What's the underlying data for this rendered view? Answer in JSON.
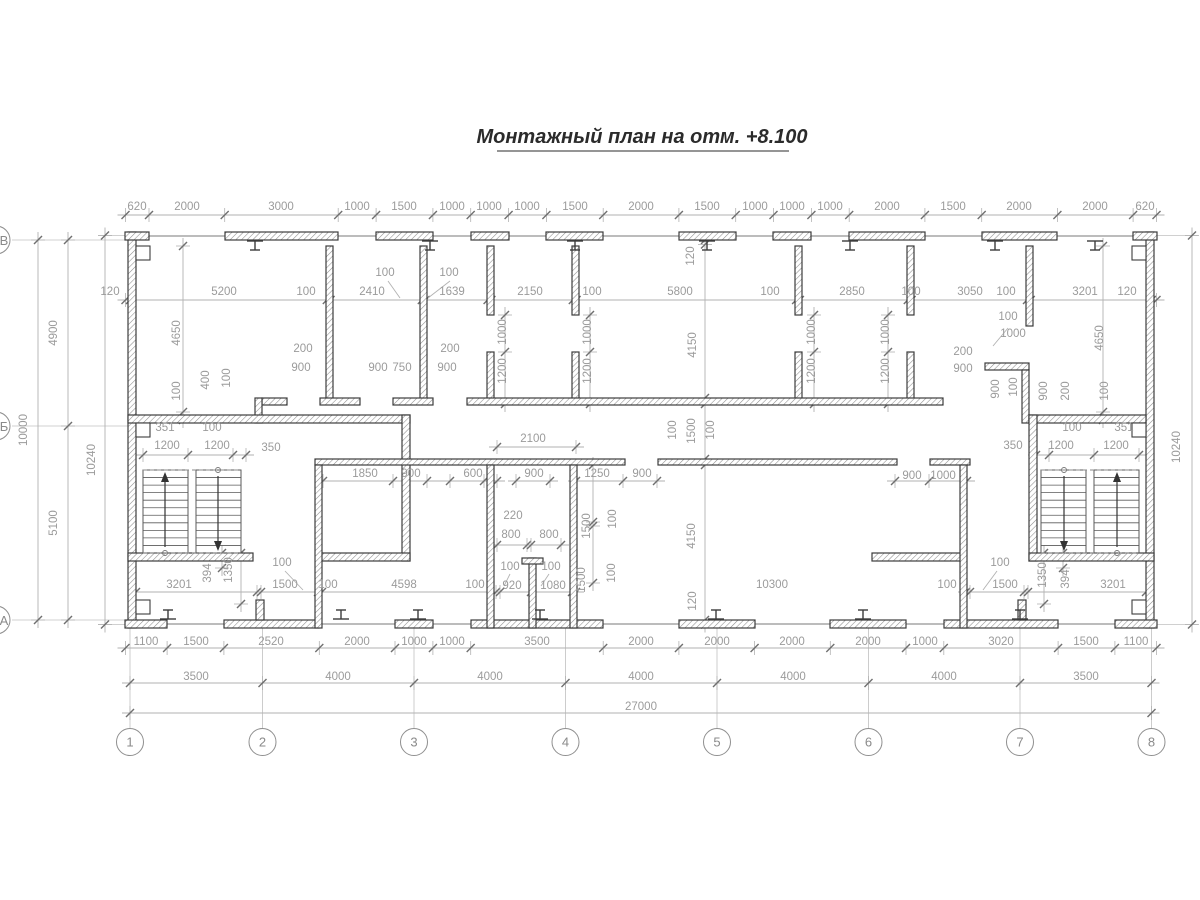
{
  "title": "Монтажный план на отм. +8.100",
  "colors": {
    "wall_line": "#3c3c3c",
    "dim_text": "#9b9b9b",
    "dim_line": "#b2b2b2",
    "tick": "#6f6f6f",
    "axis_line": "#c0c0c0",
    "bubble": "#8f8f8f",
    "stair": "#5a5a5a",
    "title": "#2b2b2b"
  },
  "grid": {
    "columns": [
      {
        "label": "1",
        "x": 130
      },
      {
        "label": "2",
        "x": 262.5
      },
      {
        "label": "3",
        "x": 414
      },
      {
        "label": "4",
        "x": 565.5
      },
      {
        "label": "5",
        "x": 717
      },
      {
        "label": "6",
        "x": 868.5
      },
      {
        "label": "7",
        "x": 1020
      },
      {
        "label": "8",
        "x": 1151.5
      }
    ],
    "bubble_y": 742,
    "rows": [
      {
        "label": "В",
        "y": 240
      },
      {
        "label": "Б",
        "y": 426
      },
      {
        "label": "А",
        "y": 620
      }
    ]
  },
  "dimension_labels": [
    [
      "620",
      137,
      210,
      0
    ],
    [
      "2000",
      187,
      210,
      0
    ],
    [
      "3000",
      281,
      210,
      0
    ],
    [
      "1000",
      357,
      210,
      0
    ],
    [
      "1500",
      404,
      210,
      0
    ],
    [
      "1000",
      452,
      210,
      0
    ],
    [
      "1000",
      489,
      210,
      0
    ],
    [
      "1000",
      527,
      210,
      0
    ],
    [
      "1500",
      575,
      210,
      0
    ],
    [
      "2000",
      641,
      210,
      0
    ],
    [
      "1500",
      707,
      210,
      0
    ],
    [
      "1000",
      755,
      210,
      0
    ],
    [
      "1000",
      792,
      210,
      0
    ],
    [
      "1000",
      830,
      210,
      0
    ],
    [
      "2000",
      887,
      210,
      0
    ],
    [
      "1500",
      953,
      210,
      0
    ],
    [
      "2000",
      1019,
      210,
      0
    ],
    [
      "2000",
      1095,
      210,
      0
    ],
    [
      "620",
      1145,
      210,
      0
    ],
    [
      "120",
      110,
      295,
      0
    ],
    [
      "5200",
      224,
      295,
      0
    ],
    [
      "100",
      306,
      295,
      0
    ],
    [
      "2410",
      372,
      295,
      0
    ],
    [
      "1639",
      452,
      295,
      0
    ],
    [
      "2150",
      530,
      295,
      0
    ],
    [
      "100",
      592,
      295,
      0
    ],
    [
      "5800",
      680,
      295,
      0
    ],
    [
      "100",
      770,
      295,
      0
    ],
    [
      "2850",
      852,
      295,
      0
    ],
    [
      "100",
      911,
      295,
      0
    ],
    [
      "3050",
      970,
      295,
      0
    ],
    [
      "100",
      1006,
      295,
      0
    ],
    [
      "3201",
      1085,
      295,
      0
    ],
    [
      "120",
      1127,
      295,
      0
    ],
    [
      "100",
      385,
      276,
      0
    ],
    [
      "100",
      449,
      276,
      0
    ],
    [
      "4650",
      180,
      333,
      1
    ],
    [
      "100",
      180,
      391,
      1
    ],
    [
      "400",
      209,
      380,
      1
    ],
    [
      "100",
      230,
      378,
      1
    ],
    [
      "351",
      165,
      431,
      0
    ],
    [
      "100",
      212,
      431,
      0
    ],
    [
      "1200",
      167,
      449,
      0
    ],
    [
      "1200",
      217,
      449,
      0
    ],
    [
      "350",
      271,
      451,
      0
    ],
    [
      "200",
      303,
      352,
      0
    ],
    [
      "900",
      301,
      371,
      0
    ],
    [
      "900",
      378,
      371,
      0
    ],
    [
      "750",
      402,
      371,
      0
    ],
    [
      "200",
      450,
      352,
      0
    ],
    [
      "900",
      447,
      371,
      0
    ],
    [
      "1000",
      506,
      332,
      1
    ],
    [
      "1200",
      506,
      371,
      1
    ],
    [
      "1000",
      591,
      332,
      1
    ],
    [
      "1200",
      591,
      371,
      1
    ],
    [
      "1000",
      815,
      332,
      1
    ],
    [
      "1200",
      815,
      371,
      1
    ],
    [
      "1000",
      889,
      332,
      1
    ],
    [
      "1200",
      889,
      371,
      1
    ],
    [
      "100",
      1008,
      320,
      0
    ],
    [
      "1000",
      1013,
      337,
      0
    ],
    [
      "200",
      963,
      355,
      0
    ],
    [
      "900",
      963,
      372,
      0
    ],
    [
      "900",
      999,
      389,
      1
    ],
    [
      "100",
      1017,
      387,
      1
    ],
    [
      "900",
      1047,
      391,
      1
    ],
    [
      "200",
      1069,
      391,
      1
    ],
    [
      "4650",
      1103,
      338,
      1
    ],
    [
      "100",
      1108,
      391,
      1
    ],
    [
      "100",
      1072,
      431,
      0
    ],
    [
      "351",
      1124,
      431,
      0
    ],
    [
      "350",
      1013,
      449,
      0
    ],
    [
      "1200",
      1061,
      449,
      0
    ],
    [
      "1200",
      1116,
      449,
      0
    ],
    [
      "120",
      694,
      256,
      1
    ],
    [
      "4150",
      696,
      345,
      1
    ],
    [
      "100",
      676,
      430,
      1
    ],
    [
      "1500",
      695,
      431,
      1
    ],
    [
      "100",
      714,
      430,
      1
    ],
    [
      "4150",
      695,
      536,
      1
    ],
    [
      "120",
      696,
      601,
      1
    ],
    [
      "2100",
      533,
      442,
      0
    ],
    [
      "1850",
      365,
      477,
      0
    ],
    [
      "900",
      411,
      477,
      0
    ],
    [
      "600",
      473,
      477,
      0
    ],
    [
      "900",
      534,
      477,
      0
    ],
    [
      "1250",
      597,
      477,
      0
    ],
    [
      "900",
      642,
      477,
      0
    ],
    [
      "900",
      912,
      479,
      0
    ],
    [
      "1000",
      943,
      479,
      0
    ],
    [
      "220",
      513,
      519,
      0
    ],
    [
      "800",
      511,
      538,
      0
    ],
    [
      "800",
      549,
      538,
      0
    ],
    [
      "100",
      510,
      570,
      0
    ],
    [
      "100",
      551,
      570,
      0
    ],
    [
      "1500",
      590,
      526,
      1
    ],
    [
      "100",
      616,
      519,
      1
    ],
    [
      "1500",
      585,
      580,
      1
    ],
    [
      "100",
      615,
      573,
      1
    ],
    [
      "100",
      475,
      588,
      0
    ],
    [
      "920",
      512,
      589,
      0
    ],
    [
      "1080",
      553,
      589,
      0
    ],
    [
      "3201",
      179,
      588,
      0
    ],
    [
      "100",
      282,
      566,
      0
    ],
    [
      "1500",
      285,
      588,
      0
    ],
    [
      "100",
      328,
      588,
      0
    ],
    [
      "4598",
      404,
      588,
      0
    ],
    [
      "394",
      211,
      573,
      1
    ],
    [
      "1350",
      232,
      570,
      1
    ],
    [
      "10300",
      772,
      588,
      0
    ],
    [
      "100",
      947,
      588,
      0
    ],
    [
      "100",
      1000,
      566,
      0
    ],
    [
      "1500",
      1005,
      588,
      0
    ],
    [
      "1350",
      1046,
      575,
      1
    ],
    [
      "394",
      1069,
      579,
      1
    ],
    [
      "3201",
      1113,
      588,
      0
    ],
    [
      "1100",
      146,
      645,
      0
    ],
    [
      "1500",
      196,
      645,
      0
    ],
    [
      "2520",
      271,
      645,
      0
    ],
    [
      "2000",
      357,
      645,
      0
    ],
    [
      "1000",
      414,
      645,
      0
    ],
    [
      "1000",
      452,
      645,
      0
    ],
    [
      "3500",
      537,
      645,
      0
    ],
    [
      "2000",
      641,
      645,
      0
    ],
    [
      "2000",
      717,
      645,
      0
    ],
    [
      "2000",
      792,
      645,
      0
    ],
    [
      "2000",
      868,
      645,
      0
    ],
    [
      "1000",
      925,
      645,
      0
    ],
    [
      "3020",
      1001,
      645,
      0
    ],
    [
      "1500",
      1086,
      645,
      0
    ],
    [
      "1100",
      1136,
      645,
      0
    ],
    [
      "3500",
      196,
      680,
      0
    ],
    [
      "4000",
      338,
      680,
      0
    ],
    [
      "4000",
      490,
      680,
      0
    ],
    [
      "4000",
      641,
      680,
      0
    ],
    [
      "4000",
      793,
      680,
      0
    ],
    [
      "4000",
      944,
      680,
      0
    ],
    [
      "3500",
      1086,
      680,
      0
    ],
    [
      "27000",
      641,
      710,
      0
    ],
    [
      "10000",
      27,
      430,
      1
    ],
    [
      "4900",
      57,
      333,
      1
    ],
    [
      "5100",
      57,
      523,
      1
    ],
    [
      "10240",
      95,
      460,
      1
    ],
    [
      "10240",
      1180,
      447,
      1
    ]
  ],
  "dimension_chains": {
    "horizontal": [
      {
        "y": 215,
        "t": [
          125.5,
          149,
          224.7,
          338.2,
          376.1,
          432.9,
          470.7,
          508.6,
          546.4,
          603.2,
          678.9,
          735.7,
          773.5,
          811.4,
          849.2,
          924.9,
          981.7,
          1057.4,
          1133.1,
          1156.5
        ]
      },
      {
        "y": 300,
        "t": [
          125.5,
          130,
          326.8,
          330.6,
          421.8,
          425.6,
          487.6,
          491.4,
          572.8,
          576.6,
          796.1,
          799.9,
          907.8,
          911.6,
          1027,
          1030.8,
          1151.9,
          1156.5
        ]
      },
      {
        "y": 447,
        "t": [
          497,
          576
        ]
      },
      {
        "y": 455,
        "t": [
          143,
          188,
          233,
          246
        ]
      },
      {
        "y": 455,
        "t": [
          1036,
          1049,
          1094,
          1139
        ]
      },
      {
        "y": 481,
        "t": [
          323,
          393,
          427,
          450,
          484,
          497
        ]
      },
      {
        "y": 481,
        "t": [
          516,
          550
        ]
      },
      {
        "y": 481,
        "t": [
          576,
          623,
          657
        ]
      },
      {
        "y": 481,
        "t": [
          895,
          929,
          967
        ]
      },
      {
        "y": 545,
        "t": [
          497,
          527,
          531,
          561
        ]
      },
      {
        "y": 592,
        "t": [
          136,
          257,
          261,
          318,
          322,
          496,
          500,
          531,
          572,
          576
        ]
      },
      {
        "y": 592,
        "t": [
          966,
          970,
          1024,
          1028,
          1146
        ]
      },
      {
        "y": 648,
        "t": [
          125.5,
          167.1,
          223.9,
          319.3,
          395,
          432.9,
          470.7,
          603.2,
          678.9,
          754.6,
          830.3,
          906,
          943.8,
          1058.1,
          1114.9,
          1156.5
        ]
      },
      {
        "y": 683,
        "t": [
          130,
          262.5,
          414,
          565.5,
          717,
          868.5,
          1020,
          1151.5
        ]
      },
      {
        "y": 713,
        "t": [
          130,
          1151.5
        ]
      }
    ],
    "vertical": [
      {
        "x": 38,
        "t": [
          240,
          620
        ]
      },
      {
        "x": 68,
        "t": [
          240,
          426,
          620
        ]
      },
      {
        "x": 105,
        "t": [
          235.5,
          624.5
        ]
      },
      {
        "x": 1192,
        "t": [
          235.5,
          624.5
        ]
      },
      {
        "x": 183,
        "t": [
          246,
          412,
          420
        ]
      },
      {
        "x": 705,
        "t": [
          240,
          244.5,
          398,
          404,
          459,
          465,
          620,
          624.5
        ]
      },
      {
        "x": 505,
        "t": [
          315,
          352,
          404
        ]
      },
      {
        "x": 590,
        "t": [
          315,
          352,
          404
        ]
      },
      {
        "x": 814,
        "t": [
          315,
          352,
          404
        ]
      },
      {
        "x": 888,
        "t": [
          315,
          352,
          404
        ]
      },
      {
        "x": 1103,
        "t": [
          246,
          412,
          420
        ]
      },
      {
        "x": 593,
        "t": [
          465,
          522,
          526,
          583
        ]
      },
      {
        "x": 222,
        "t": [
          553,
          568
        ]
      },
      {
        "x": 241,
        "t": [
          553,
          604
        ]
      },
      {
        "x": 1044,
        "t": [
          553,
          604
        ]
      },
      {
        "x": 1063,
        "t": [
          553,
          568
        ]
      }
    ]
  },
  "leaders": [
    [
      388,
      281,
      400,
      298
    ],
    [
      450,
      281,
      428,
      298
    ],
    [
      285,
      571,
      303,
      590
    ],
    [
      997,
      571,
      983,
      590
    ],
    [
      510,
      574,
      504,
      586
    ],
    [
      549,
      574,
      541,
      586
    ],
    [
      1008,
      328,
      993,
      346
    ]
  ],
  "walls": [
    [
      128,
      232,
      8,
      396
    ],
    [
      1146,
      232,
      8,
      396
    ],
    [
      125,
      232,
      24,
      8
    ],
    [
      225,
      232,
      113,
      8
    ],
    [
      376,
      232,
      57,
      8
    ],
    [
      471,
      232,
      38,
      8
    ],
    [
      546,
      232,
      57,
      8
    ],
    [
      679,
      232,
      57,
      8
    ],
    [
      773,
      232,
      38,
      8
    ],
    [
      849,
      232,
      76,
      8
    ],
    [
      982,
      232,
      75,
      8
    ],
    [
      1133,
      232,
      24,
      8
    ],
    [
      125,
      620,
      42,
      8
    ],
    [
      224,
      620,
      95,
      8
    ],
    [
      395,
      620,
      38,
      8
    ],
    [
      471,
      620,
      132,
      8
    ],
    [
      679,
      620,
      76,
      8
    ],
    [
      830,
      620,
      76,
      8
    ],
    [
      944,
      620,
      114,
      8
    ],
    [
      1115,
      620,
      42,
      8
    ],
    [
      326,
      246,
      7,
      158
    ],
    [
      420,
      246,
      7,
      158
    ],
    [
      487,
      246,
      7,
      69
    ],
    [
      487,
      352,
      7,
      52
    ],
    [
      572,
      246,
      7,
      69
    ],
    [
      572,
      352,
      7,
      52
    ],
    [
      795,
      246,
      7,
      69
    ],
    [
      795,
      352,
      7,
      52
    ],
    [
      907,
      246,
      7,
      69
    ],
    [
      907,
      352,
      7,
      52
    ],
    [
      1026,
      246,
      7,
      80
    ],
    [
      262,
      398,
      25,
      7
    ],
    [
      320,
      398,
      40,
      7
    ],
    [
      393,
      398,
      40,
      7
    ],
    [
      467,
      398,
      476,
      7
    ],
    [
      255,
      398,
      7,
      25
    ],
    [
      985,
      363,
      44,
      7
    ],
    [
      1022,
      370,
      7,
      53
    ],
    [
      128,
      415,
      282,
      8
    ],
    [
      402,
      415,
      8,
      146
    ],
    [
      1029,
      415,
      117,
      8
    ],
    [
      1029,
      415,
      8,
      146
    ],
    [
      128,
      553,
      125,
      8
    ],
    [
      318,
      553,
      92,
      8
    ],
    [
      872,
      553,
      92,
      8
    ],
    [
      1029,
      553,
      125,
      8
    ],
    [
      315,
      459,
      310,
      6
    ],
    [
      658,
      459,
      239,
      6
    ],
    [
      930,
      459,
      40,
      6
    ],
    [
      315,
      465,
      7,
      163
    ],
    [
      960,
      465,
      7,
      163
    ],
    [
      487,
      465,
      7,
      163
    ],
    [
      570,
      465,
      7,
      163
    ],
    [
      529,
      558,
      7,
      70
    ],
    [
      522,
      558,
      21,
      6
    ],
    [
      256,
      600,
      8,
      20
    ],
    [
      1018,
      600,
      8,
      20
    ]
  ],
  "notches": [
    [
      136,
      246
    ],
    [
      1132,
      246
    ],
    [
      136,
      423
    ],
    [
      1132,
      423
    ],
    [
      136,
      600
    ],
    [
      1132,
      600
    ]
  ],
  "ibeams": {
    "top": [
      255,
      430,
      575,
      707,
      850,
      995,
      1095
    ],
    "bottom": [
      168,
      341,
      418,
      540,
      716,
      863,
      1020
    ]
  },
  "glazing_lines": [
    [
      127,
      236,
      1155,
      236
    ],
    [
      127,
      624,
      1155,
      624
    ]
  ],
  "ext_lines": [
    [
      1154,
      235.5,
      1198,
      235.5
    ],
    [
      1154,
      624.5,
      1198,
      624.5
    ],
    [
      98,
      235.5,
      127,
      235.5
    ],
    [
      98,
      624.5,
      127,
      624.5
    ],
    [
      12,
      240,
      128,
      240
    ],
    [
      12,
      426,
      128,
      426
    ],
    [
      12,
      620,
      128,
      620
    ]
  ],
  "stairs": [
    {
      "x1": 143,
      "gapA": 188,
      "gapB": 196,
      "x2": 241,
      "y1": 470,
      "y2": 553,
      "upX": 165,
      "downX": 218,
      "circTop": 218,
      "circBot": 165
    },
    {
      "x1": 1041,
      "gapA": 1086,
      "gapB": 1094,
      "x2": 1139,
      "y1": 470,
      "y2": 553,
      "upX": 1117,
      "downX": 1064,
      "circTop": 1064,
      "circBot": 1117
    }
  ]
}
